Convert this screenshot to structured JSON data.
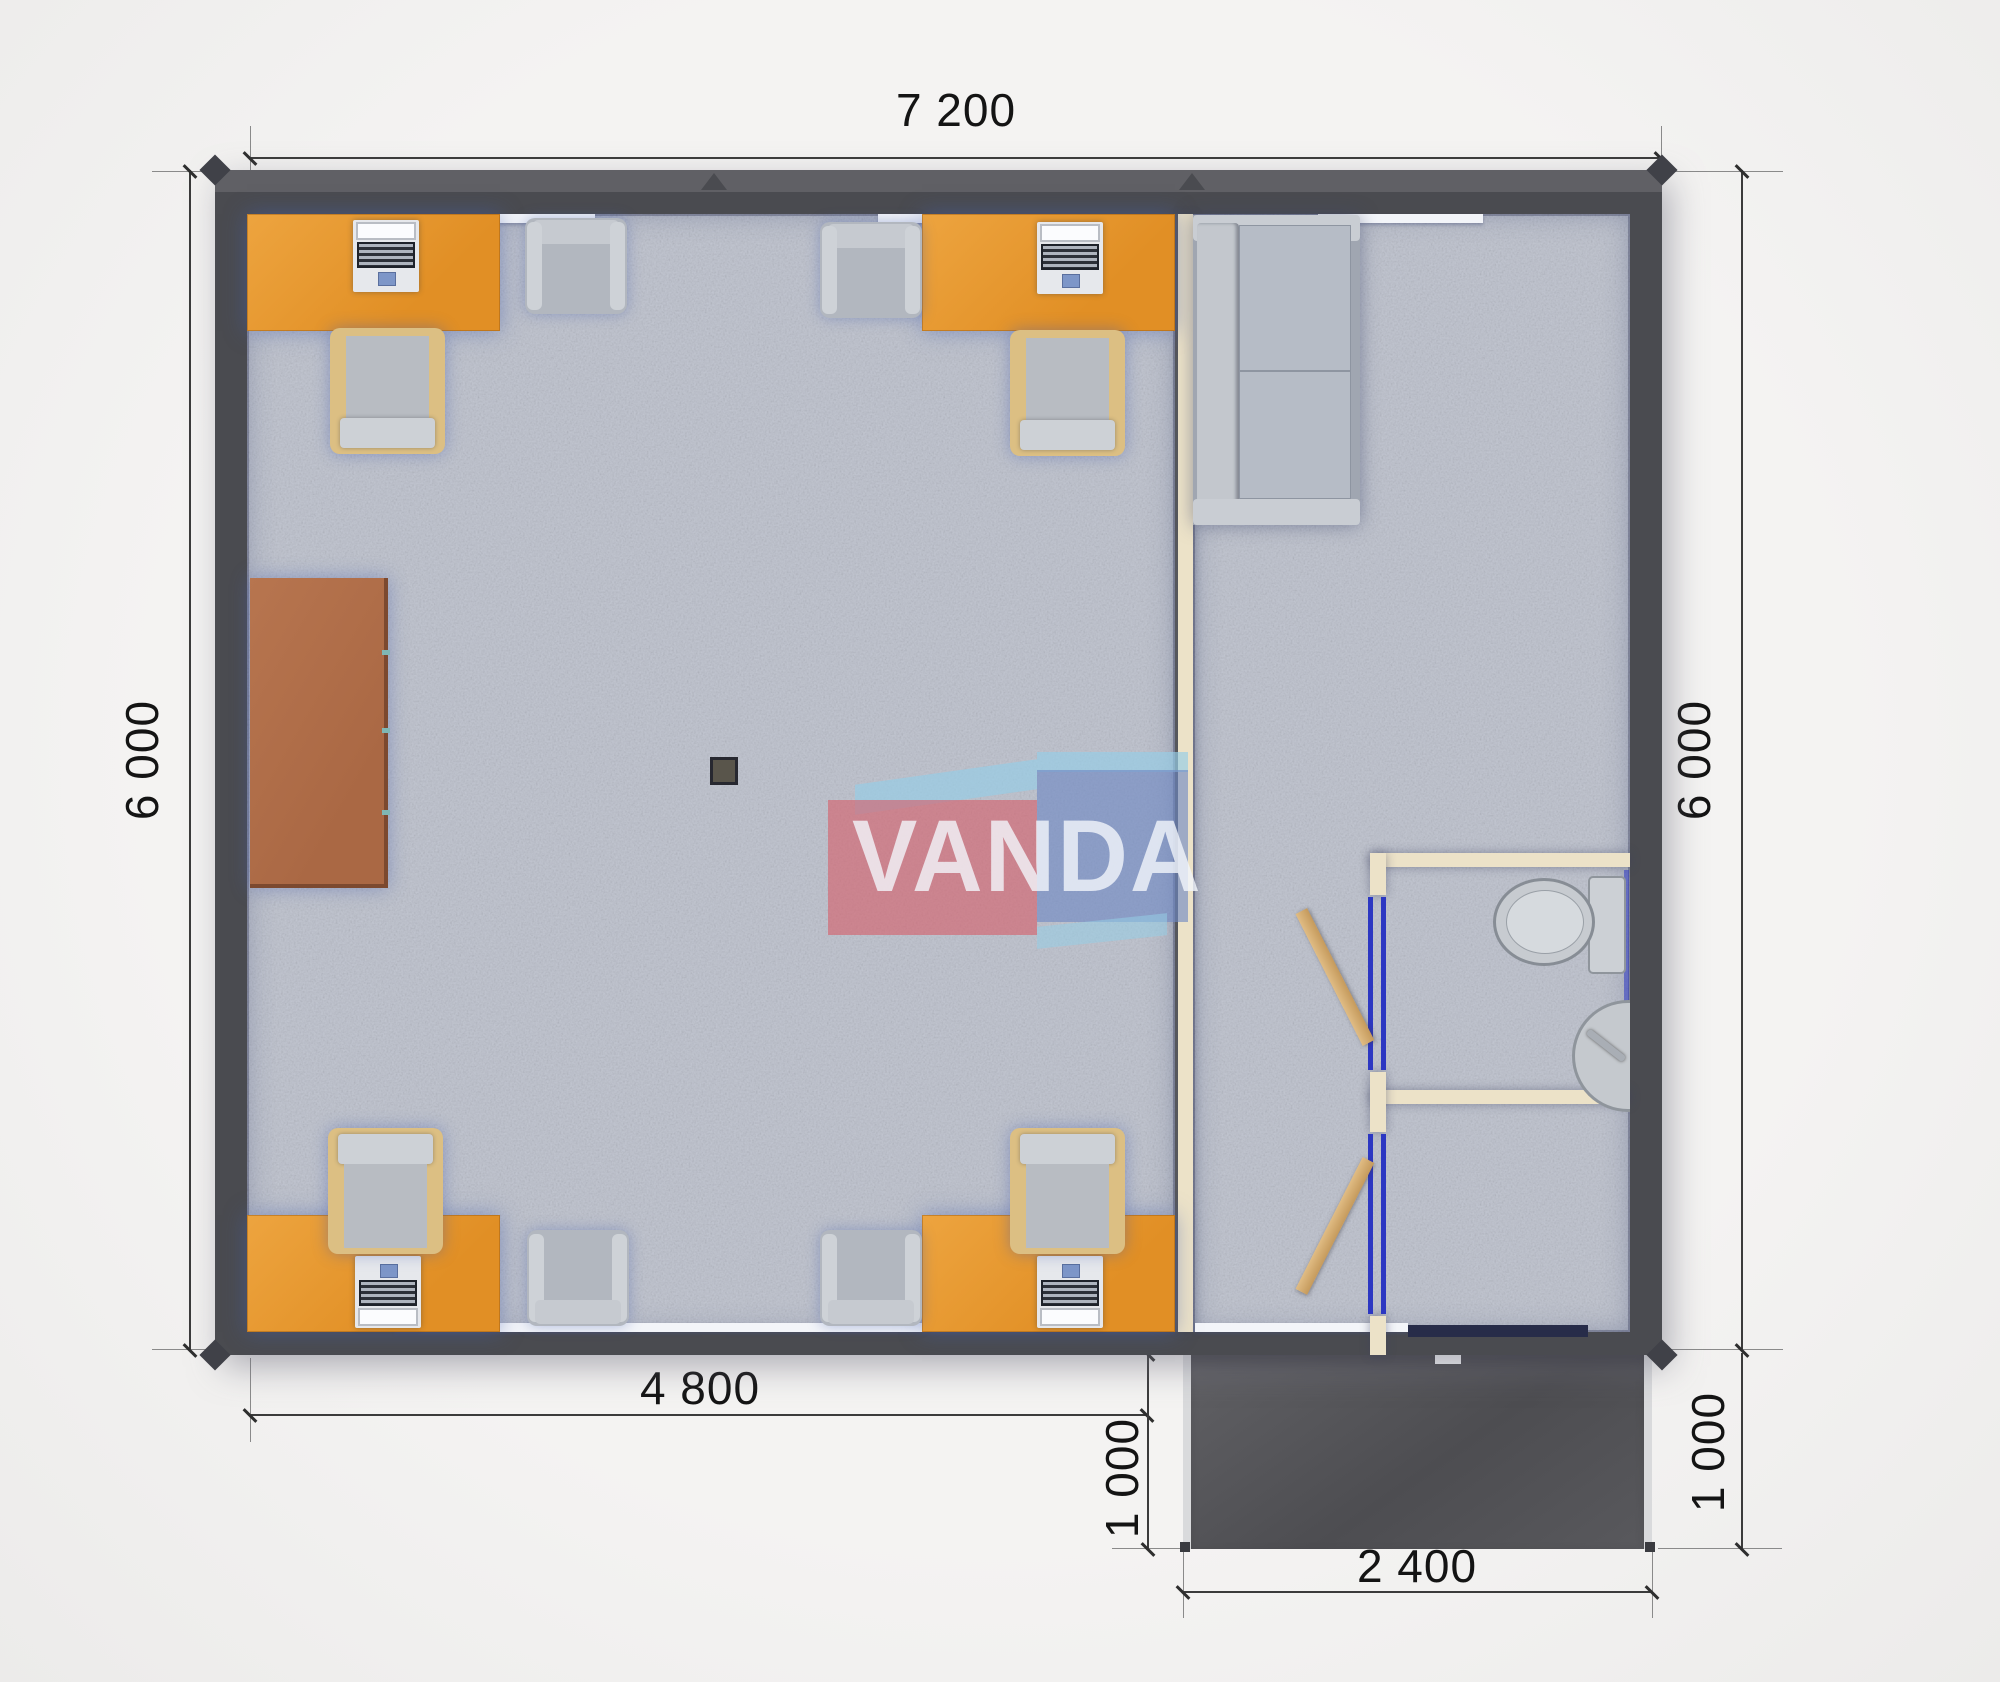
{
  "title": "modular office floor plan",
  "watermark": {
    "text": "VANDA",
    "red": "#d55f6a",
    "blue": "#6e88c4",
    "light_blue": "#96cde6",
    "letter_color": "#f2f6fb"
  },
  "dimensions": {
    "top_width": "7 200",
    "left_height": "6 000",
    "right_height": "6 000",
    "bottom_left_width": "4 800",
    "porch_height_left": "1 000",
    "porch_height_right": "1 000",
    "porch_width": "2 400"
  },
  "colors": {
    "wall": "#4a4b50",
    "floor": "#b9bdc8",
    "desk_orange": "#e6952e",
    "cabinet_brown": "#b06f4e",
    "chair_tan": "#dcbf83",
    "furniture_gray": "#b2b7bf",
    "bath_wall_tan": "#ece2c8",
    "door_frame_blue": "#2c37c2",
    "porch_dark": "#505054",
    "dimension_text": "#141414"
  },
  "rooms": {
    "office": [
      "desk-with-laptop x4",
      "office-chair x4",
      "armchair x4",
      "storage-cabinet",
      "floor-drain"
    ],
    "lounge": [
      "sofa",
      "open-door x2"
    ],
    "bathroom": [
      "toilet",
      "sink"
    ],
    "exterior": [
      "entrance-porch"
    ]
  }
}
